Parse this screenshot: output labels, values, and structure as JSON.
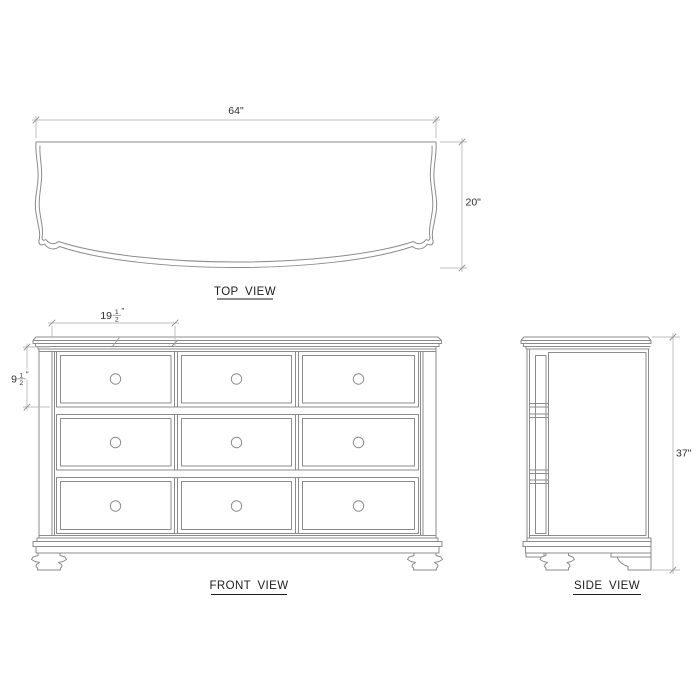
{
  "colors": {
    "background": "#ffffff",
    "drawing_line": "#8b8b8b",
    "dimension_line": "#bcbcbc",
    "text": "#2f2f2f"
  },
  "views": {
    "top": {
      "label": "TOP VIEW",
      "width_dim": "64\"",
      "depth_dim": "20\""
    },
    "front": {
      "label": "FRONT VIEW",
      "drawer_rows": 3,
      "drawer_columns": 3,
      "knob_count": 9,
      "drawer_width_dim": {
        "whole": "19",
        "numerator": "1",
        "denominator": "2",
        "unit": "\""
      },
      "drawer_height_dim": {
        "whole": "9",
        "numerator": "1",
        "denominator": "2",
        "unit": "\""
      }
    },
    "side": {
      "label": "SIDE VIEW",
      "height_dim": "37\""
    }
  }
}
